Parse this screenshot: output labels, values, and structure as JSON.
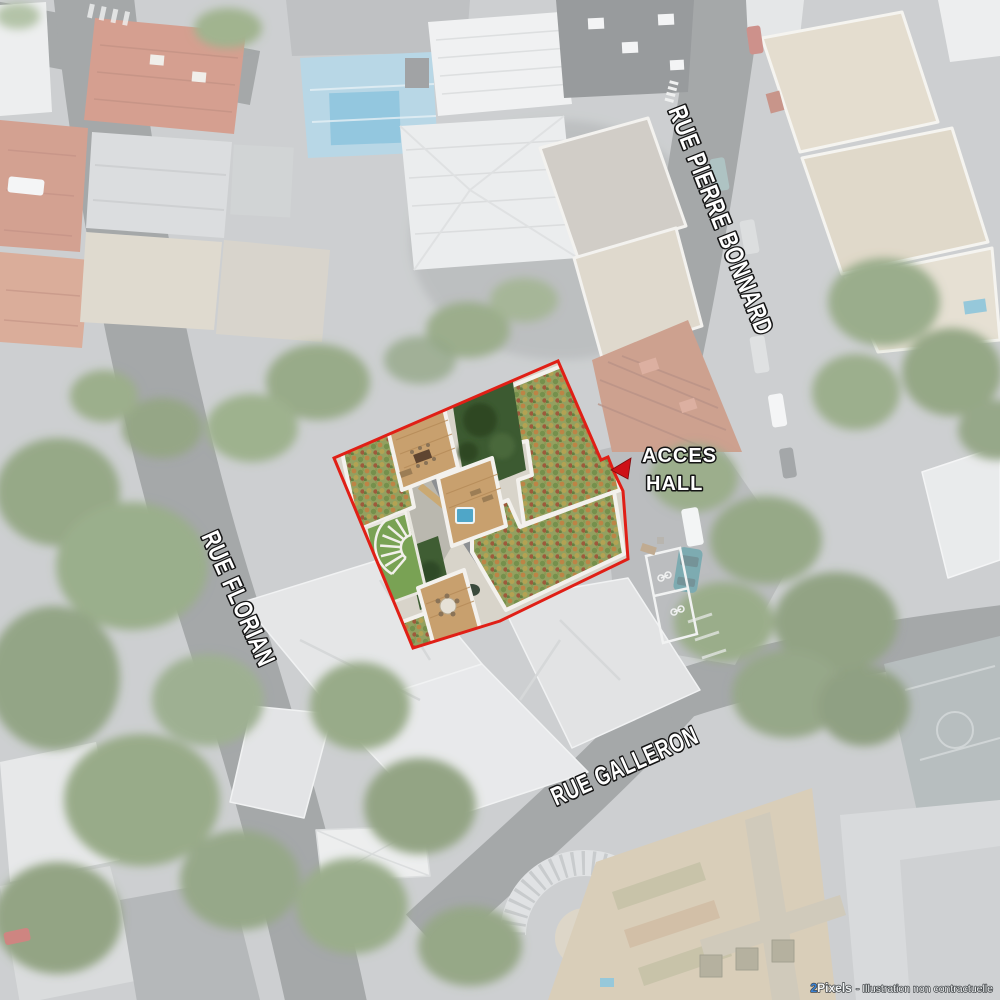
{
  "streets": [
    {
      "name": "RUE PIERRE BONNARD"
    },
    {
      "name": "RUE FLORIAN"
    },
    {
      "name": "RUE GALLERON"
    }
  ],
  "access": {
    "line1": "ACCES",
    "line2": "HALL",
    "marker_icon": "red-triangle-left"
  },
  "site": {
    "outline_color": "#e01f16",
    "marker_color": "#ce1117"
  },
  "watermark": {
    "brand_prefix": "2",
    "brand_name": "Pixels",
    "note": "- Illustration non contractuelle",
    "brand_color": "#2f7cd3"
  }
}
